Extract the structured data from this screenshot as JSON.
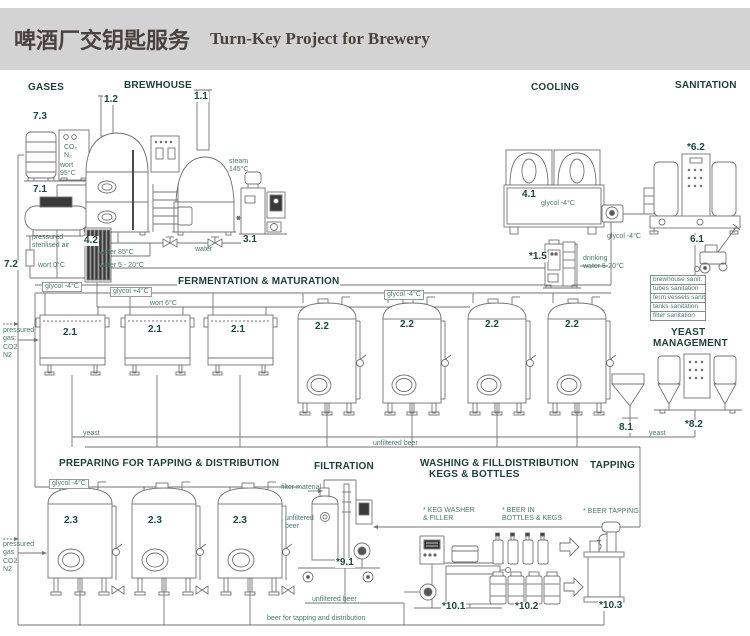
{
  "header": {
    "title_zh": "啤酒厂交钥匙服务",
    "title_en": "Turn-Key Project for Brewery"
  },
  "colors": {
    "band": "#d3d3d3",
    "title": "#4b423e",
    "section": "#1e3f38",
    "number": "#1d4841",
    "small_label": "#4e7a6e",
    "line": "#737373"
  },
  "labels": [
    {
      "id": "section-gases",
      "text": "GASES",
      "x": 27,
      "y": 82,
      "cls": "sec"
    },
    {
      "id": "section-brewhouse",
      "text": "BREWHOUSE",
      "x": 123,
      "y": 80,
      "cls": "sec"
    },
    {
      "id": "section-cooling",
      "text": "COOLING",
      "x": 530,
      "y": 82,
      "cls": "sec"
    },
    {
      "id": "section-sanitation",
      "text": "SANITATION",
      "x": 674,
      "y": 80,
      "cls": "sec"
    },
    {
      "id": "section-fermentation",
      "text": "FERMENTATION & MATURATION",
      "x": 177,
      "y": 276,
      "cls": "sec"
    },
    {
      "id": "section-yeast-line1",
      "text": "YEAST",
      "x": 670,
      "y": 327,
      "cls": "sec"
    },
    {
      "id": "section-yeast-line2",
      "text": "MANAGEMENT",
      "x": 652,
      "y": 338,
      "cls": "sec"
    },
    {
      "id": "section-preparing",
      "text": "PREPARING FOR TAPPING & DISTRIBUTION",
      "x": 58,
      "y": 458,
      "cls": "sec"
    },
    {
      "id": "section-filtration",
      "text": "FILTRATION",
      "x": 313,
      "y": 461,
      "cls": "sec"
    },
    {
      "id": "section-washing-line1",
      "text": "WASHING & FILLING",
      "x": 419,
      "y": 458,
      "cls": "sec"
    },
    {
      "id": "section-washing-line2",
      "text": "KEGS & BOTTLES",
      "x": 428,
      "y": 469,
      "cls": "sec"
    },
    {
      "id": "section-distribution",
      "text": "DISTRIBUTION",
      "x": 504,
      "y": 458,
      "cls": "sec"
    },
    {
      "id": "section-tapping",
      "text": "TAPPING",
      "x": 589,
      "y": 460,
      "cls": "sec"
    },
    {
      "id": "num-7-3",
      "text": "7.3",
      "x": 32,
      "y": 112,
      "cls": "num"
    },
    {
      "id": "num-1-2",
      "text": "1.2",
      "x": 103,
      "y": 95,
      "cls": "num"
    },
    {
      "id": "num-1-1",
      "text": "1.1",
      "x": 193,
      "y": 92,
      "cls": "num"
    },
    {
      "id": "num-7-1",
      "text": "7.1",
      "x": 32,
      "y": 185,
      "cls": "num"
    },
    {
      "id": "num-7-2",
      "text": "7.2",
      "x": 3,
      "y": 260,
      "cls": "num"
    },
    {
      "id": "num-4-2",
      "text": "4.2",
      "x": 83,
      "y": 236,
      "cls": "num"
    },
    {
      "id": "num-3-1",
      "text": "3.1",
      "x": 242,
      "y": 235,
      "cls": "num"
    },
    {
      "id": "num-4-1",
      "text": "4.1",
      "x": 521,
      "y": 190,
      "cls": "num"
    },
    {
      "id": "num-1-5",
      "text": "*1.5",
      "x": 528,
      "y": 252,
      "cls": "num"
    },
    {
      "id": "num-6-2",
      "text": "*6.2",
      "x": 686,
      "y": 143,
      "cls": "num"
    },
    {
      "id": "num-6-1",
      "text": "6.1",
      "x": 689,
      "y": 235,
      "cls": "num"
    },
    {
      "id": "num-2-1-a",
      "text": "2.1",
      "x": 62,
      "y": 328,
      "cls": "num"
    },
    {
      "id": "num-2-1-b",
      "text": "2.1",
      "x": 147,
      "y": 325,
      "cls": "num"
    },
    {
      "id": "num-2-1-c",
      "text": "2.1",
      "x": 230,
      "y": 325,
      "cls": "num"
    },
    {
      "id": "num-2-2-a",
      "text": "2.2",
      "x": 314,
      "y": 322,
      "cls": "num"
    },
    {
      "id": "num-2-2-b",
      "text": "2.2",
      "x": 399,
      "y": 320,
      "cls": "num"
    },
    {
      "id": "num-2-2-c",
      "text": "2.2",
      "x": 484,
      "y": 320,
      "cls": "num"
    },
    {
      "id": "num-2-2-d",
      "text": "2.2",
      "x": 564,
      "y": 320,
      "cls": "num"
    },
    {
      "id": "num-8-1",
      "text": "8.1",
      "x": 618,
      "y": 423,
      "cls": "num"
    },
    {
      "id": "num-8-2",
      "text": "*8.2",
      "x": 684,
      "y": 420,
      "cls": "num"
    },
    {
      "id": "num-2-3-a",
      "text": "2.3",
      "x": 63,
      "y": 516,
      "cls": "num"
    },
    {
      "id": "num-2-3-b",
      "text": "2.3",
      "x": 147,
      "y": 516,
      "cls": "num"
    },
    {
      "id": "num-2-3-c",
      "text": "2.3",
      "x": 232,
      "y": 516,
      "cls": "num"
    },
    {
      "id": "num-9-1",
      "text": "*9.1",
      "x": 335,
      "y": 558,
      "cls": "num"
    },
    {
      "id": "num-10-1",
      "text": "*10.1",
      "x": 441,
      "y": 602,
      "cls": "num"
    },
    {
      "id": "num-10-2",
      "text": "*10.2",
      "x": 514,
      "y": 602,
      "cls": "num"
    },
    {
      "id": "num-10-3",
      "text": "*10.3",
      "x": 598,
      "y": 601,
      "cls": "num"
    },
    {
      "id": "pipe-wort-95",
      "text": "wort\n95°C",
      "x": 60,
      "y": 162,
      "cls": "lbl"
    },
    {
      "id": "pipe-sterilised-air",
      "text": "pressured\nsterilised air",
      "x": 32,
      "y": 234,
      "cls": "lbl"
    },
    {
      "id": "pipe-wort-0",
      "text": "wort 0°C",
      "x": 38,
      "y": 262,
      "cls": "lbl"
    },
    {
      "id": "pipe-water-85",
      "text": "water 85°C",
      "x": 99,
      "y": 249,
      "cls": "lbl"
    },
    {
      "id": "pipe-water-5-20",
      "text": "water 5 - 20°C",
      "x": 99,
      "y": 262,
      "cls": "lbl"
    },
    {
      "id": "pipe-water",
      "text": "water",
      "x": 195,
      "y": 246,
      "cls": "lbl"
    },
    {
      "id": "pipe-steam-145",
      "text": "steam\n145°C",
      "x": 229,
      "y": 158,
      "cls": "lbl"
    },
    {
      "id": "pipe-glycol-minus4-a",
      "text": "glycol -4°C",
      "x": 42,
      "y": 282,
      "cls": "lblbox"
    },
    {
      "id": "pipe-glycol-plus4",
      "text": "glycol +4°C",
      "x": 110,
      "y": 287,
      "cls": "lblbox"
    },
    {
      "id": "pipe-glycol-minus4-b",
      "text": "glycol -4°C",
      "x": 384,
      "y": 290,
      "cls": "lblbox"
    },
    {
      "id": "chiller-glycol-label",
      "text": "glycol -4°C",
      "x": 541,
      "y": 200,
      "cls": "lbl"
    },
    {
      "id": "pipe-glycol-minus4-c",
      "text": "glycol -4°C",
      "x": 607,
      "y": 233,
      "cls": "lbl"
    },
    {
      "id": "pipe-drinking-water",
      "text": "drinking\nwater 5-20°C",
      "x": 583,
      "y": 255,
      "cls": "lbl"
    },
    {
      "id": "pipe-wort-6",
      "text": "wort 6°C",
      "x": 150,
      "y": 300,
      "cls": "lbl"
    },
    {
      "id": "gas-supply-top",
      "text": "pressured\ngas:\nCO2\nN2",
      "x": 3,
      "y": 327,
      "cls": "lbl"
    },
    {
      "id": "pipe-yeast-left",
      "text": "yeast",
      "x": 83,
      "y": 430,
      "cls": "lbl"
    },
    {
      "id": "pipe-unfiltered-beer-a",
      "text": "unfiltered beer",
      "x": 373,
      "y": 440,
      "cls": "lbl"
    },
    {
      "id": "pipe-yeast-right",
      "text": "yeast",
      "x": 649,
      "y": 430,
      "cls": "lbl"
    },
    {
      "id": "san-row-brewhouse",
      "text": "brewhouse sanit.",
      "x": 650,
      "y": 275,
      "cls": "san"
    },
    {
      "id": "san-row-tubes",
      "text": "tubes sanitation",
      "x": 650,
      "y": 284,
      "cls": "san"
    },
    {
      "id": "san-row-ferm",
      "text": "ferm.vessels sanit.",
      "x": 650,
      "y": 293,
      "cls": "san"
    },
    {
      "id": "san-row-tanks",
      "text": "tanks sanitation",
      "x": 650,
      "y": 302,
      "cls": "san"
    },
    {
      "id": "san-row-filter",
      "text": "filter sanitation",
      "x": 650,
      "y": 311,
      "cls": "san"
    },
    {
      "id": "gas-panel-co2-n2",
      "text": "CO₂\nN₂",
      "x": 64,
      "y": 144,
      "cls": "lbl"
    },
    {
      "id": "pipe-glycol-minus4-d",
      "text": "glycol -4°C",
      "x": 49,
      "y": 479,
      "cls": "lblbox"
    },
    {
      "id": "gas-supply-bottom",
      "text": "pressured\ngas\nCO2\nN2",
      "x": 3,
      "y": 541,
      "cls": "lbl"
    },
    {
      "id": "filter-material-label",
      "text": "filter material",
      "x": 281,
      "y": 484,
      "cls": "lbl"
    },
    {
      "id": "pipe-unfiltered-beer-b",
      "text": "unfiltered\nbeer",
      "x": 285,
      "y": 515,
      "cls": "lbl"
    },
    {
      "id": "pipe-unfiltered-beer-c",
      "text": "unfiltered beer",
      "x": 312,
      "y": 596,
      "cls": "lbl"
    },
    {
      "id": "pipe-beer-tapping-dist",
      "text": "beer for tapping and distribution",
      "x": 267,
      "y": 615,
      "cls": "lbl"
    },
    {
      "id": "keg-washer-label",
      "text": "* KEG WASHER\n& FILLER",
      "x": 423,
      "y": 507,
      "cls": "lbl"
    },
    {
      "id": "beer-in-bottles-label",
      "text": "* BEER IN\nBOTTLES & KEGS",
      "x": 502,
      "y": 507,
      "cls": "lbl"
    },
    {
      "id": "beer-tapping-label",
      "text": "* BEER TAPPING",
      "x": 583,
      "y": 508,
      "cls": "lbl"
    }
  ]
}
